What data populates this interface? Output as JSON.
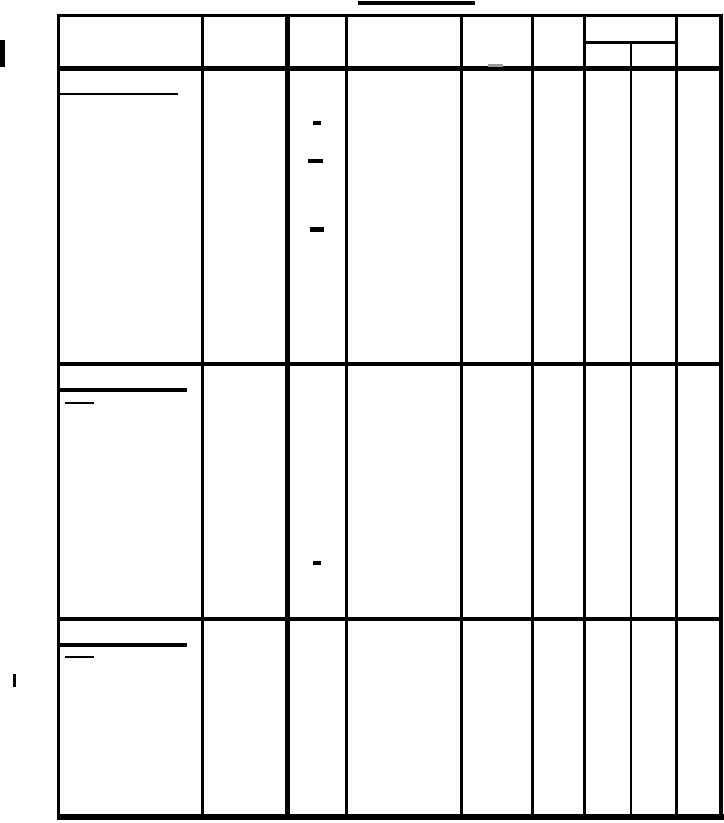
{
  "page": {
    "width": 724,
    "height": 823,
    "background": "#ffffff",
    "ink_color": "#000000",
    "faint_ink_color": "#9a9a9a",
    "description": "Blank scanned table form page; ruled grid with no legible text, only underline and dash marks remaining"
  },
  "title": {
    "text": "",
    "underline": {
      "name": "title-underline",
      "x": 358,
      "y": 1,
      "w": 117,
      "h": 4,
      "tone": "ink"
    }
  },
  "table": {
    "x": 57,
    "y": 14,
    "width": 667,
    "height": 806,
    "rows": 3,
    "columns": 8,
    "header_has_split_column": true,
    "h_lines": [
      {
        "name": "table-top-border",
        "x": 57,
        "y": 14,
        "w": 664,
        "h": 3,
        "tone": "ink"
      },
      {
        "name": "header-subcolumn-divider",
        "x": 584,
        "y": 41,
        "w": 93,
        "h": 3,
        "tone": "ink"
      },
      {
        "name": "header-bottom-border",
        "x": 57,
        "y": 66,
        "w": 664,
        "h": 5,
        "tone": "ink"
      },
      {
        "name": "row-divider-1",
        "x": 57,
        "y": 362,
        "w": 664,
        "h": 4,
        "tone": "ink"
      },
      {
        "name": "row-divider-2",
        "x": 57,
        "y": 617,
        "w": 664,
        "h": 4,
        "tone": "ink"
      },
      {
        "name": "table-bottom-border",
        "x": 57,
        "y": 814,
        "w": 667,
        "h": 6,
        "tone": "ink"
      }
    ],
    "v_lines": [
      {
        "name": "table-left-border",
        "x": 57,
        "y": 14,
        "w": 3,
        "h": 806,
        "tone": "ink"
      },
      {
        "name": "column-line-1",
        "x": 201,
        "y": 14,
        "w": 3,
        "h": 806,
        "tone": "ink"
      },
      {
        "name": "column-line-2-thick",
        "x": 285,
        "y": 14,
        "w": 5,
        "h": 806,
        "tone": "ink"
      },
      {
        "name": "column-line-3",
        "x": 345,
        "y": 14,
        "w": 3,
        "h": 806,
        "tone": "ink"
      },
      {
        "name": "column-line-4",
        "x": 460,
        "y": 14,
        "w": 3,
        "h": 806,
        "tone": "ink"
      },
      {
        "name": "column-line-5",
        "x": 531,
        "y": 14,
        "w": 3,
        "h": 806,
        "tone": "ink"
      },
      {
        "name": "column-line-6",
        "x": 583,
        "y": 14,
        "w": 3,
        "h": 806,
        "tone": "ink"
      },
      {
        "name": "subcolumn-line",
        "x": 630,
        "y": 41,
        "w": 2,
        "h": 779,
        "tone": "ink"
      },
      {
        "name": "column-line-7",
        "x": 675,
        "y": 14,
        "w": 3,
        "h": 806,
        "tone": "ink"
      },
      {
        "name": "table-right-border",
        "x": 719,
        "y": 14,
        "w": 4,
        "h": 806,
        "tone": "ink"
      }
    ]
  },
  "marks": [
    {
      "name": "left-edge-bar",
      "x": 0,
      "y": 40,
      "w": 5,
      "h": 27,
      "tone": "ink"
    },
    {
      "name": "left-margin-tick",
      "x": 13,
      "y": 674,
      "w": 3,
      "h": 13,
      "tone": "ink"
    },
    {
      "name": "header-col5-dash",
      "x": 488,
      "y": 64,
      "w": 15,
      "h": 3,
      "tone": "faint"
    },
    {
      "name": "row1-col1-underline",
      "x": 58,
      "y": 93,
      "w": 120,
      "h": 2,
      "tone": "ink"
    },
    {
      "name": "row1-col3-dash-1",
      "x": 313,
      "y": 121,
      "w": 8,
      "h": 4,
      "tone": "ink"
    },
    {
      "name": "row1-col3-dash-2",
      "x": 308,
      "y": 159,
      "w": 15,
      "h": 4,
      "tone": "ink"
    },
    {
      "name": "row1-col3-dash-3",
      "x": 310,
      "y": 227,
      "w": 14,
      "h": 5,
      "tone": "ink"
    },
    {
      "name": "row2-col1-underline",
      "x": 58,
      "y": 388,
      "w": 129,
      "h": 4,
      "tone": "ink"
    },
    {
      "name": "row2-col1-short-underline",
      "x": 65,
      "y": 402,
      "w": 29,
      "h": 2,
      "tone": "ink"
    },
    {
      "name": "row2-col3-dash",
      "x": 313,
      "y": 561,
      "w": 8,
      "h": 4,
      "tone": "ink"
    },
    {
      "name": "row3-col1-underline",
      "x": 58,
      "y": 643,
      "w": 129,
      "h": 4,
      "tone": "ink"
    },
    {
      "name": "row3-col1-short-underline",
      "x": 65,
      "y": 656,
      "w": 29,
      "h": 2,
      "tone": "ink"
    }
  ]
}
